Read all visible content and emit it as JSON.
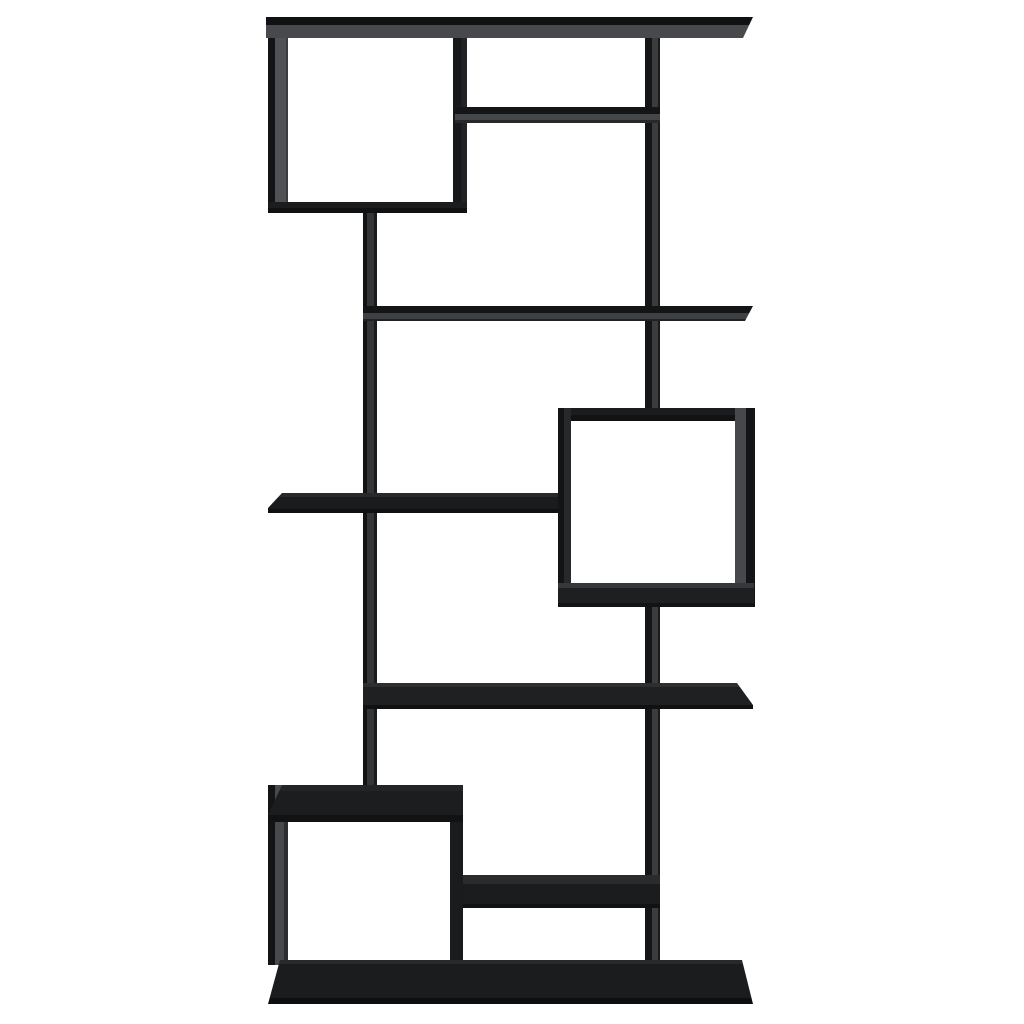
{
  "scene": {
    "type": "product-photo",
    "object": "black geometric asymmetric cube bookshelf (room divider shelving unit)",
    "finish_color_name": "black",
    "background_color": "#ffffff",
    "view": "front elevation with slight wide-angle perspective",
    "canvas": {
      "width": 1024,
      "height": 1024
    }
  },
  "palette": {
    "edge_black": "#101112",
    "panel_black": "#1b1c1e",
    "inner_face_gray": "#47494c",
    "left_wall_gray": "#505255",
    "background_white": "#ffffff"
  },
  "structure_summary": {
    "closed_cubes": 3,
    "open_shelf_levels": 6,
    "cube_positions": [
      "top-left",
      "middle-right",
      "bottom-left"
    ],
    "vertical_posts": 2,
    "base": "full-width bottom plinth"
  },
  "parts": [
    {
      "name": "cube1-left-wall",
      "x": 268,
      "y": 17,
      "w": 20,
      "h": 196,
      "bg": "linear-gradient(90deg,#131415 0 7px,#505255 7px 18px,#3a3c3e 18px)"
    },
    {
      "name": "cube1-right-wall",
      "x": 453,
      "y": 17,
      "w": 14,
      "h": 196,
      "bg": "linear-gradient(90deg,#17181a 0 60%,#222326 60%)"
    },
    {
      "name": "right-post-upper",
      "x": 645,
      "y": 17,
      "w": 15,
      "h": 398,
      "bg": "linear-gradient(90deg,#141516 0 7px,#3a3c3e 7px 13px,#1a1b1c 13px)"
    },
    {
      "name": "left-post",
      "x": 363,
      "y": 213,
      "w": 14,
      "h": 572,
      "bg": "linear-gradient(90deg,#111213 0 4px,#333537 4px 11px,#1a1b1c 11px)"
    },
    {
      "name": "right-post-lower",
      "x": 645,
      "y": 597,
      "w": 15,
      "h": 368,
      "bg": "linear-gradient(90deg,#141516 0 7px,#3a3c3e 7px 13px,#1a1b1c 13px)"
    },
    {
      "name": "top-shelf",
      "x": 266,
      "y": 17,
      "w": 487,
      "h": 21,
      "bg": "linear-gradient(#101112 0 8px,#47494c 8px)",
      "clip": "polygon(0 0, 100% 0, calc(100% - 10px) 100%, 0 100%)"
    },
    {
      "name": "cube1-bottom-panel",
      "x": 268,
      "y": 202,
      "w": 199,
      "h": 11,
      "bg": "linear-gradient(#1b1c1e 0 6px,#101112 6px)"
    },
    {
      "name": "upper-right-shelf",
      "x": 455,
      "y": 107,
      "w": 205,
      "h": 16,
      "bg": "linear-gradient(#141517 0 7px,#44474a 7px 13px,#26282a 13px)"
    },
    {
      "name": "second-shelf",
      "x": 363,
      "y": 306,
      "w": 390,
      "h": 15,
      "bg": "linear-gradient(#131416 0 7px,#3e4144 7px 13px,#202124 13px)",
      "clip": "polygon(0 0, 100% 0, calc(100% - 8px) 100%, 0 100%)"
    },
    {
      "name": "middle-left-shelf",
      "x": 268,
      "y": 493,
      "w": 290,
      "h": 20,
      "bg": "linear-gradient(#28292b 0 4px,#1a1b1d 4px 16px,#0f1011 16px)",
      "clip": "polygon(14px 0, 100% 0, 100% 100%, 0 100%, 0 15px)"
    },
    {
      "name": "cube2-top-panel",
      "x": 558,
      "y": 408,
      "w": 196,
      "h": 13,
      "bg": "linear-gradient(#1b1c1e 0 7px,#111213 7px)",
      "clip": "polygon(0 0, calc(100% - 9px) 0, 100% 100%, 0 100%)"
    },
    {
      "name": "cube2-left-wall",
      "x": 558,
      "y": 408,
      "w": 13,
      "h": 199,
      "bg": "linear-gradient(90deg,#131415 0 6px,#27282a 6px)"
    },
    {
      "name": "cube2-right-wall",
      "x": 735,
      "y": 408,
      "w": 20,
      "h": 199,
      "bg": "linear-gradient(90deg,#46484b 0 11px,#131416 11px)"
    },
    {
      "name": "cube2-bottom-panel",
      "x": 558,
      "y": 583,
      "w": 196,
      "h": 24,
      "bg": "linear-gradient(#35373a 0 5px,#1e1f21 5px 20px,#121314 20px)"
    },
    {
      "name": "fourth-shelf",
      "x": 363,
      "y": 683,
      "w": 390,
      "h": 26,
      "bg": "linear-gradient(#2c2e30 0 4px,#1f2022 4px 22px,#101112 22px)",
      "clip": "polygon(0 0, calc(100% - 16px) 0, 100% 22px, 100% 100%, 0 100%)"
    },
    {
      "name": "cube3-left-wall",
      "x": 268,
      "y": 785,
      "w": 20,
      "h": 180,
      "bg": "linear-gradient(90deg,#131415 0 7px,#47494c 7px 16px,#2c2d2f 16px)"
    },
    {
      "name": "cube3-right-wall",
      "x": 450,
      "y": 785,
      "w": 13,
      "h": 180,
      "bg": "#1a1b1d"
    },
    {
      "name": "cube3-top-panel",
      "x": 268,
      "y": 785,
      "w": 195,
      "h": 37,
      "bg": "linear-gradient(#222426 0 6px,#1c1d1f 6px 30px,#111213 30px)",
      "clip": "polygon(14px 0, 100% 0, 100% 100%, 2px 100%, 0 30px)"
    },
    {
      "name": "lower-right-shelf",
      "x": 463,
      "y": 875,
      "w": 197,
      "h": 33,
      "bg": "linear-gradient(#292b2d 0 9px,#1b1c1e 9px 29px,#111213 29px)"
    },
    {
      "name": "base-plinth",
      "x": 268,
      "y": 960,
      "w": 485,
      "h": 44,
      "bg": "linear-gradient(#28292b 0 4px,#1b1c1e 4px 38px,#0d0e0f 38px)",
      "clip": "polygon(12px 0, 474px 0, 100% 100%, 0 100%)"
    }
  ]
}
